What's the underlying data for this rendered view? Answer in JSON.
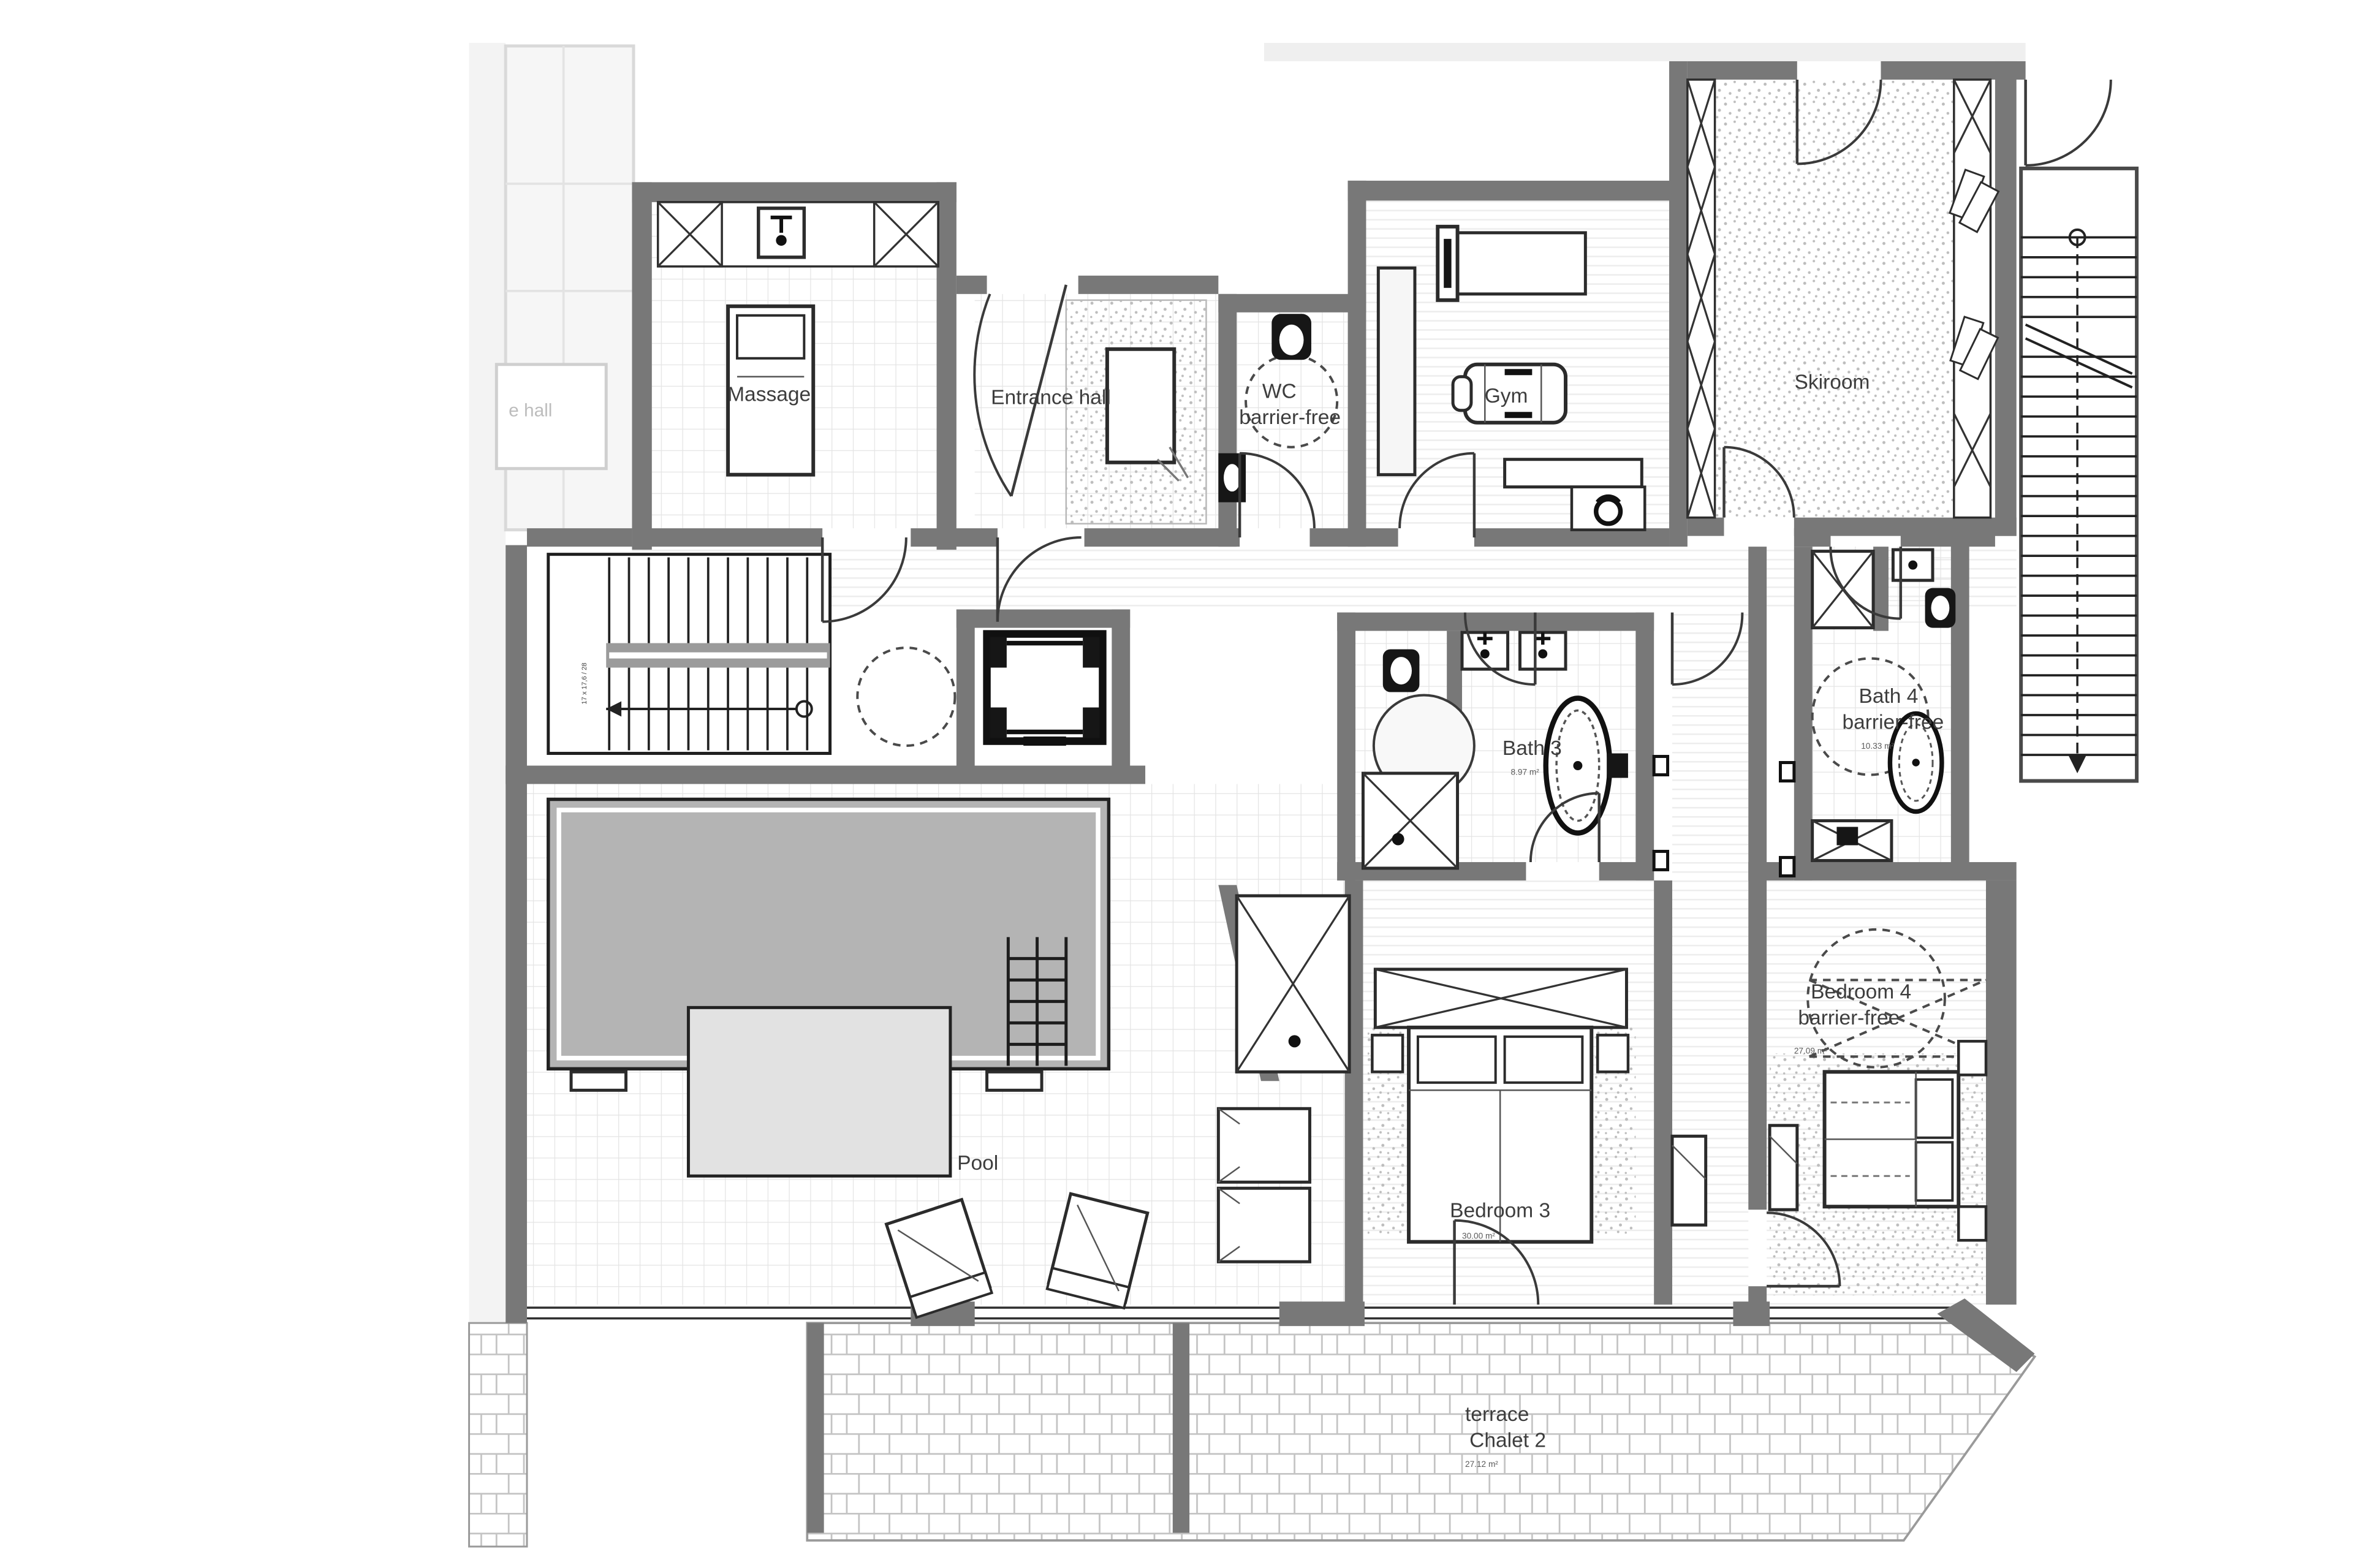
{
  "document": {
    "type": "architectural-floor-plan",
    "description": "Chalet lower floor plan with wellness area, bedrooms and terrace"
  },
  "colors": {
    "wall": "#787878",
    "wall_dark": "#4f4f4f",
    "line": "#2b2b2b",
    "water": "#b4b4b4",
    "tile": "#e4e4e4",
    "stone": "#c3c3c3",
    "faded": "#d9d9d9",
    "label": "#3d3d3d"
  },
  "rooms": {
    "massage": {
      "label": "Massage"
    },
    "entrance_hall": {
      "label": "Entrance hall"
    },
    "wc": {
      "label_line1": "WC",
      "label_line2": "barrier-free"
    },
    "gym": {
      "label": "Gym"
    },
    "skiroom": {
      "label": "Skiroom"
    },
    "bath3": {
      "label": "Bath 3",
      "area": "8.97 m²"
    },
    "bath4": {
      "label_line1": "Bath 4",
      "label_line2": "barrier-free",
      "area": "10.33 m²"
    },
    "bedroom3": {
      "label": "Bedroom 3",
      "area": "30.00 m²"
    },
    "bedroom4": {
      "label_line1": "Bedroom 4",
      "label_line2": "barrier-free",
      "area": "27.09 m²"
    },
    "pool_hall": {
      "label": "Pool"
    },
    "terrace": {
      "label_line1": "terrace",
      "label_line2": "Chalet 2",
      "area": "27.12 m²"
    },
    "neighbor": {
      "label": "e hall"
    },
    "stair_left": {
      "annotation": "17 x 17,6 / 28"
    }
  }
}
